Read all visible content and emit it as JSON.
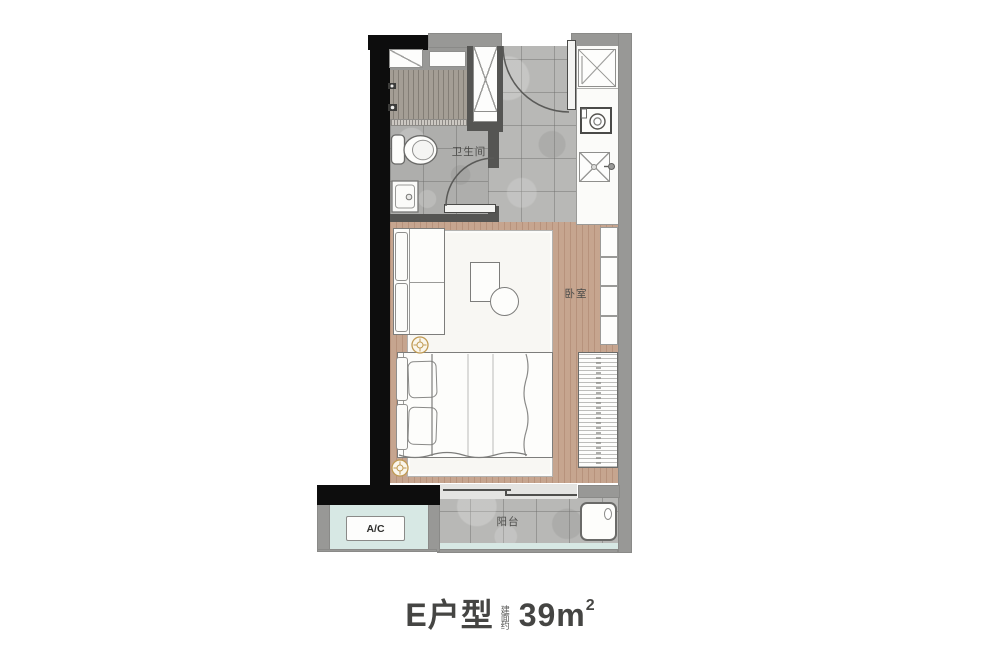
{
  "floor_plan": {
    "labels": {
      "bathroom": "卫生间",
      "bedroom": "卧室",
      "balcony": "阳台",
      "ac_unit": "A/C"
    },
    "title": {
      "unit_name": "E户型",
      "area_note": "建面约",
      "area_value": "39m",
      "area_superscript": "2"
    },
    "colors": {
      "wall_black": "#0d0d0d",
      "wall_gray": "#989896",
      "partition_gray": "#555553",
      "wood_floor": "#c6a58f",
      "tile_floor": "#b8b8b6",
      "shower_tile": "#a49e95",
      "glass_teal": "#d7e8e4",
      "rug_white": "#f8f7f3",
      "label_text": "#4c4c4a",
      "title_text": "#454543"
    }
  }
}
